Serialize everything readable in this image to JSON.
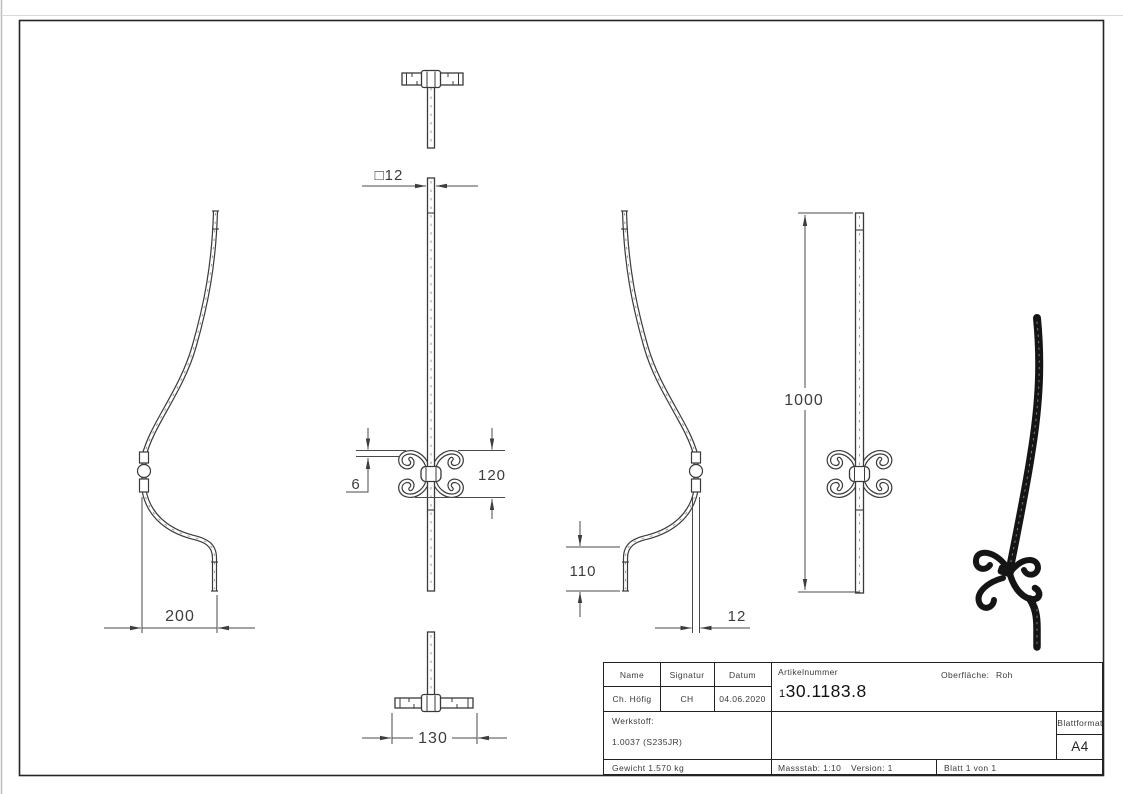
{
  "drawing": {
    "dims": {
      "square12": "□12",
      "w200": "200",
      "t6": "6",
      "h120": "120",
      "h110": "110",
      "w12": "12",
      "h1000": "1000",
      "w130": "130"
    }
  },
  "title_block": {
    "col_name": "Name",
    "col_signatur": "Signatur",
    "col_datum": "Datum",
    "name": "Ch. Höfig",
    "signatur": "CH",
    "datum": "04.06.2020",
    "artikelnummer_label": "Artikelnummer",
    "artikelnummer_prefix": "1",
    "artikelnummer_rest": "30.1183.8",
    "oberflaeche_label": "Oberfläche:",
    "oberflaeche_value": "Roh",
    "werkstoff_label": "Werkstoff:",
    "werkstoff_value": "1.0037 (S235JR)",
    "blattformat_label": "Blattformat",
    "blattformat_value": "A4",
    "gewicht": "Gewicht 1.570 kg",
    "massstab": "Massstab: 1:10",
    "version": "Version: 1",
    "blatt": "Blatt 1 von 1"
  },
  "colors": {
    "line": "#3a3a3a",
    "dim_line": "#4a4a4a",
    "frame": "#252525",
    "iso_part": "#151515"
  }
}
